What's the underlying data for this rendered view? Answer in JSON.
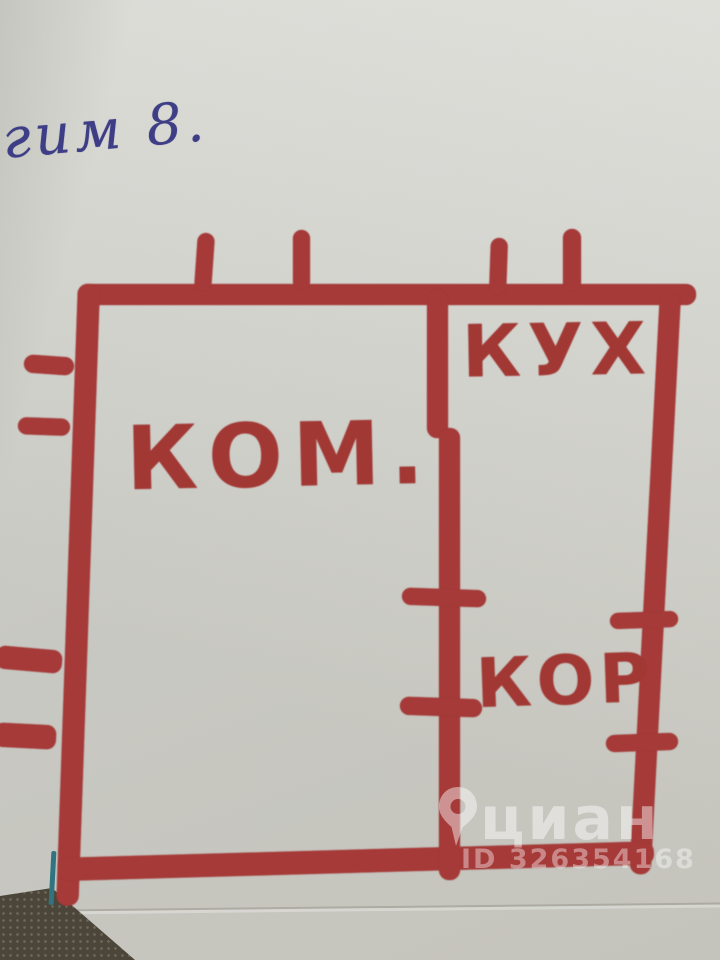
{
  "photo_subject": "hand-drawn apartment floor plan sketch in red marker on paper",
  "note": {
    "text": "гим 8."
  },
  "floor_plan": {
    "rooms": [
      {
        "id": "kom",
        "label": "КОМ.",
        "meaning": "room (комната)"
      },
      {
        "id": "kuh",
        "label": "КУХ",
        "meaning": "kitchen (кухня)"
      },
      {
        "id": "kor",
        "label": "КОР",
        "meaning": "corridor (коридор)"
      }
    ],
    "features": [
      "outer rectangular wall outline",
      "internal vertical wall separating left room from kitchen and corridor",
      "door tick marks on internal wall and right wall",
      "window tick marks on top wall and left wall"
    ]
  },
  "watermark": {
    "brand": "циан",
    "id_text": "ID 326354168",
    "icon": "cian-pin-icon"
  },
  "colors": {
    "marker_red": "#a53a38",
    "ink_blue": "#3e3e86",
    "paper": "#d4d4ce",
    "paper_edge_teal": "#2f7480",
    "floor_dark": "#4c463a",
    "watermark_white": "rgba(255,255,255,0.45)"
  }
}
